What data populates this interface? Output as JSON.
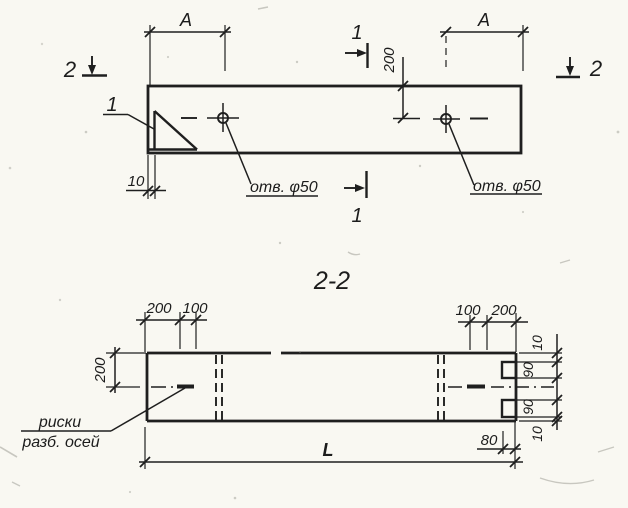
{
  "colors": {
    "ink": "#1f1f1f",
    "paper": "#f9f8f2"
  },
  "top_view": {
    "marker_1_top": "1",
    "marker_1_bottom": "1",
    "marker_2_left": "2",
    "marker_2_right": "2",
    "dim_a_left": "A",
    "dim_a_right": "A",
    "dim_200": "200",
    "dim_10": "10",
    "detail_callout": "1",
    "hole_label_left": "отв. φ50",
    "hole_label_right": "отв. φ50"
  },
  "section_view": {
    "title": "2-2",
    "dims_top_left": {
      "d200": "200",
      "d100": "100"
    },
    "dims_top_right": {
      "d100": "100",
      "d200": "200"
    },
    "dim_left_height": "200",
    "chain_right": {
      "d10_top": "10",
      "d90_top": "90",
      "d90_bottom": "90",
      "d10_bottom": "10"
    },
    "dim_80": "80",
    "dim_length": "L",
    "note_line1": "риски",
    "note_line2": "разб. осей"
  }
}
